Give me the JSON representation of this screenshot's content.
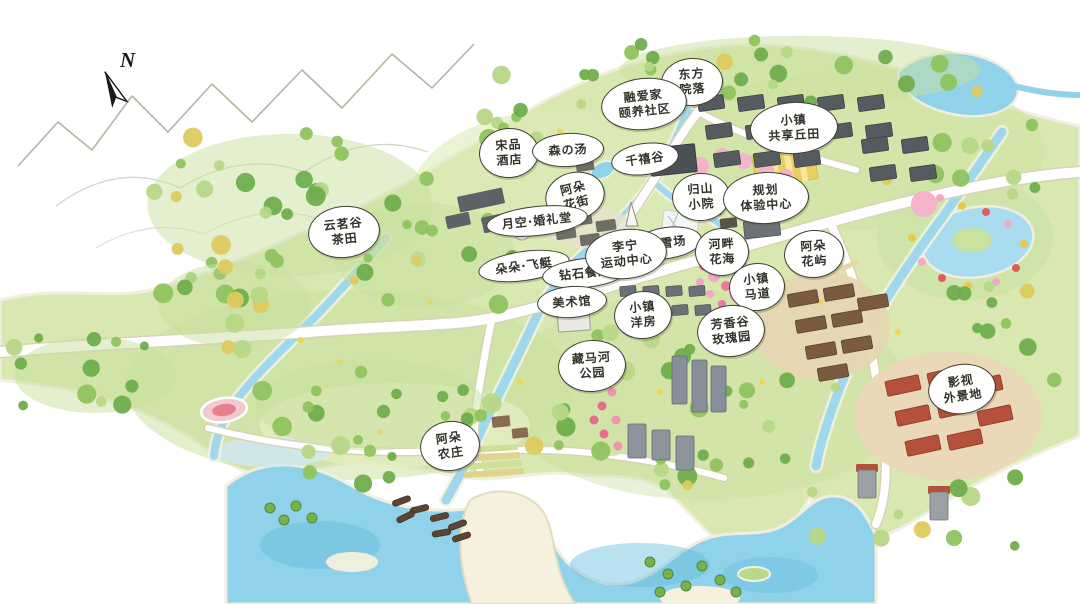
{
  "map": {
    "compass": {
      "label": "N"
    },
    "labels": [
      {
        "name": "dongfang-yuanluo",
        "lines": [
          "东方",
          "院落"
        ],
        "x": 692,
        "y": 82,
        "w": 60,
        "h": 46,
        "rot": -4
      },
      {
        "name": "rongaijia-care-community",
        "lines": [
          "融爱家",
          "颐养社区"
        ],
        "x": 644,
        "y": 104,
        "w": 84,
        "h": 50,
        "rot": -6
      },
      {
        "name": "town-shared-hill-fields",
        "lines": [
          "小镇",
          "共享丘田"
        ],
        "x": 794,
        "y": 128,
        "w": 86,
        "h": 50,
        "rot": -3
      },
      {
        "name": "songpin-hotel",
        "lines": [
          "宋品",
          "酒店"
        ],
        "x": 509,
        "y": 153,
        "w": 58,
        "h": 48,
        "rot": -4
      },
      {
        "name": "sen-no-yu-hot-spring",
        "lines": [
          "森の汤"
        ],
        "x": 568,
        "y": 150,
        "w": 70,
        "h": 32,
        "rot": -3
      },
      {
        "name": "qianxi-valley",
        "lines": [
          "千禧谷"
        ],
        "x": 645,
        "y": 159,
        "w": 66,
        "h": 30,
        "rot": -8
      },
      {
        "name": "aduo-flower-street",
        "lines": [
          "阿朵",
          "花街"
        ],
        "x": 575,
        "y": 196,
        "w": 58,
        "h": 46,
        "rot": -14
      },
      {
        "name": "guishan-courtyard",
        "lines": [
          "归山",
          "小院"
        ],
        "x": 701,
        "y": 197,
        "w": 56,
        "h": 46,
        "rot": -4
      },
      {
        "name": "planning-experience-center",
        "lines": [
          "规划",
          "体验中心"
        ],
        "x": 766,
        "y": 198,
        "w": 84,
        "h": 50,
        "rot": -3
      },
      {
        "name": "moon-sky-wedding-hall",
        "lines": [
          "月空·婚礼堂"
        ],
        "x": 537,
        "y": 221,
        "w": 100,
        "h": 28,
        "rot": -6
      },
      {
        "name": "yunming-valley-tea-fields",
        "lines": [
          "云茗谷",
          "茶田"
        ],
        "x": 344,
        "y": 232,
        "w": 70,
        "h": 50,
        "rot": -6
      },
      {
        "name": "ski-resort",
        "lines": [
          "滑雪场"
        ],
        "x": 667,
        "y": 243,
        "w": 68,
        "h": 30,
        "rot": -8
      },
      {
        "name": "riverside-flower-sea",
        "lines": [
          "河畔",
          "花海"
        ],
        "x": 722,
        "y": 252,
        "w": 52,
        "h": 46,
        "rot": -3
      },
      {
        "name": "aduo-flower-isle",
        "lines": [
          "阿朵",
          "花屿"
        ],
        "x": 814,
        "y": 254,
        "w": 58,
        "h": 46,
        "rot": -4
      },
      {
        "name": "duoduo-airship",
        "lines": [
          "朵朵·飞艇"
        ],
        "x": 524,
        "y": 266,
        "w": 90,
        "h": 28,
        "rot": -8
      },
      {
        "name": "diamond-restaurant",
        "lines": [
          "钻石餐厅"
        ],
        "x": 585,
        "y": 273,
        "w": 84,
        "h": 28,
        "rot": -6
      },
      {
        "name": "lining-sports-center",
        "lines": [
          "李宁",
          "运动中心"
        ],
        "x": 626,
        "y": 254,
        "w": 80,
        "h": 48,
        "rot": -6
      },
      {
        "name": "town-bridle-path",
        "lines": [
          "小镇",
          "马道"
        ],
        "x": 757,
        "y": 287,
        "w": 54,
        "h": 46,
        "rot": -5
      },
      {
        "name": "art-museum",
        "lines": [
          "美术馆"
        ],
        "x": 572,
        "y": 302,
        "w": 68,
        "h": 30,
        "rot": -4
      },
      {
        "name": "town-terrace-houses",
        "lines": [
          "小镇",
          "洋房"
        ],
        "x": 643,
        "y": 315,
        "w": 56,
        "h": 46,
        "rot": -5
      },
      {
        "name": "fragrance-valley-rose-garden",
        "lines": [
          "芳香谷",
          "玫瑰园"
        ],
        "x": 731,
        "y": 331,
        "w": 66,
        "h": 50,
        "rot": -6
      },
      {
        "name": "zangma-river-park",
        "lines": [
          "藏马河",
          "公园"
        ],
        "x": 592,
        "y": 366,
        "w": 66,
        "h": 50,
        "rot": -4
      },
      {
        "name": "film-studio-location",
        "lines": [
          "影视",
          "外景地"
        ],
        "x": 962,
        "y": 389,
        "w": 66,
        "h": 48,
        "rot": -8
      },
      {
        "name": "aduo-farm",
        "lines": [
          "阿朵",
          "农庄"
        ],
        "x": 450,
        "y": 446,
        "w": 58,
        "h": 48,
        "rot": -8
      }
    ]
  },
  "palette": {
    "land": "#d9e8b0",
    "land_shade": "#c9df9e",
    "sand": "#f6f1de",
    "water": "#8fd2e9",
    "water_deep": "#67bcdc",
    "river": "#9fd8ec",
    "marsh": "#cfe9f2",
    "road": "#ffffff",
    "road_casing": "#d6d0b8",
    "trail": "#e6d7ab",
    "mountain_line": "#9fae90",
    "tree_dark": "#6fae4c",
    "tree_mid": "#8fc45e",
    "tree_light": "#b7d786",
    "tree_yellow": "#ddca5e",
    "roof_dark": "#565b60",
    "roof_brown": "#7a5b40",
    "roof_red": "#b5503a",
    "field_yellow": "#e9cf63",
    "flower_pink": "#f2a9c4",
    "flower_red": "#e05b5b",
    "label_bg": "#ffffff",
    "label_border": "#403f36",
    "label_text": "#33322a",
    "compass": "#1a1a1a"
  }
}
